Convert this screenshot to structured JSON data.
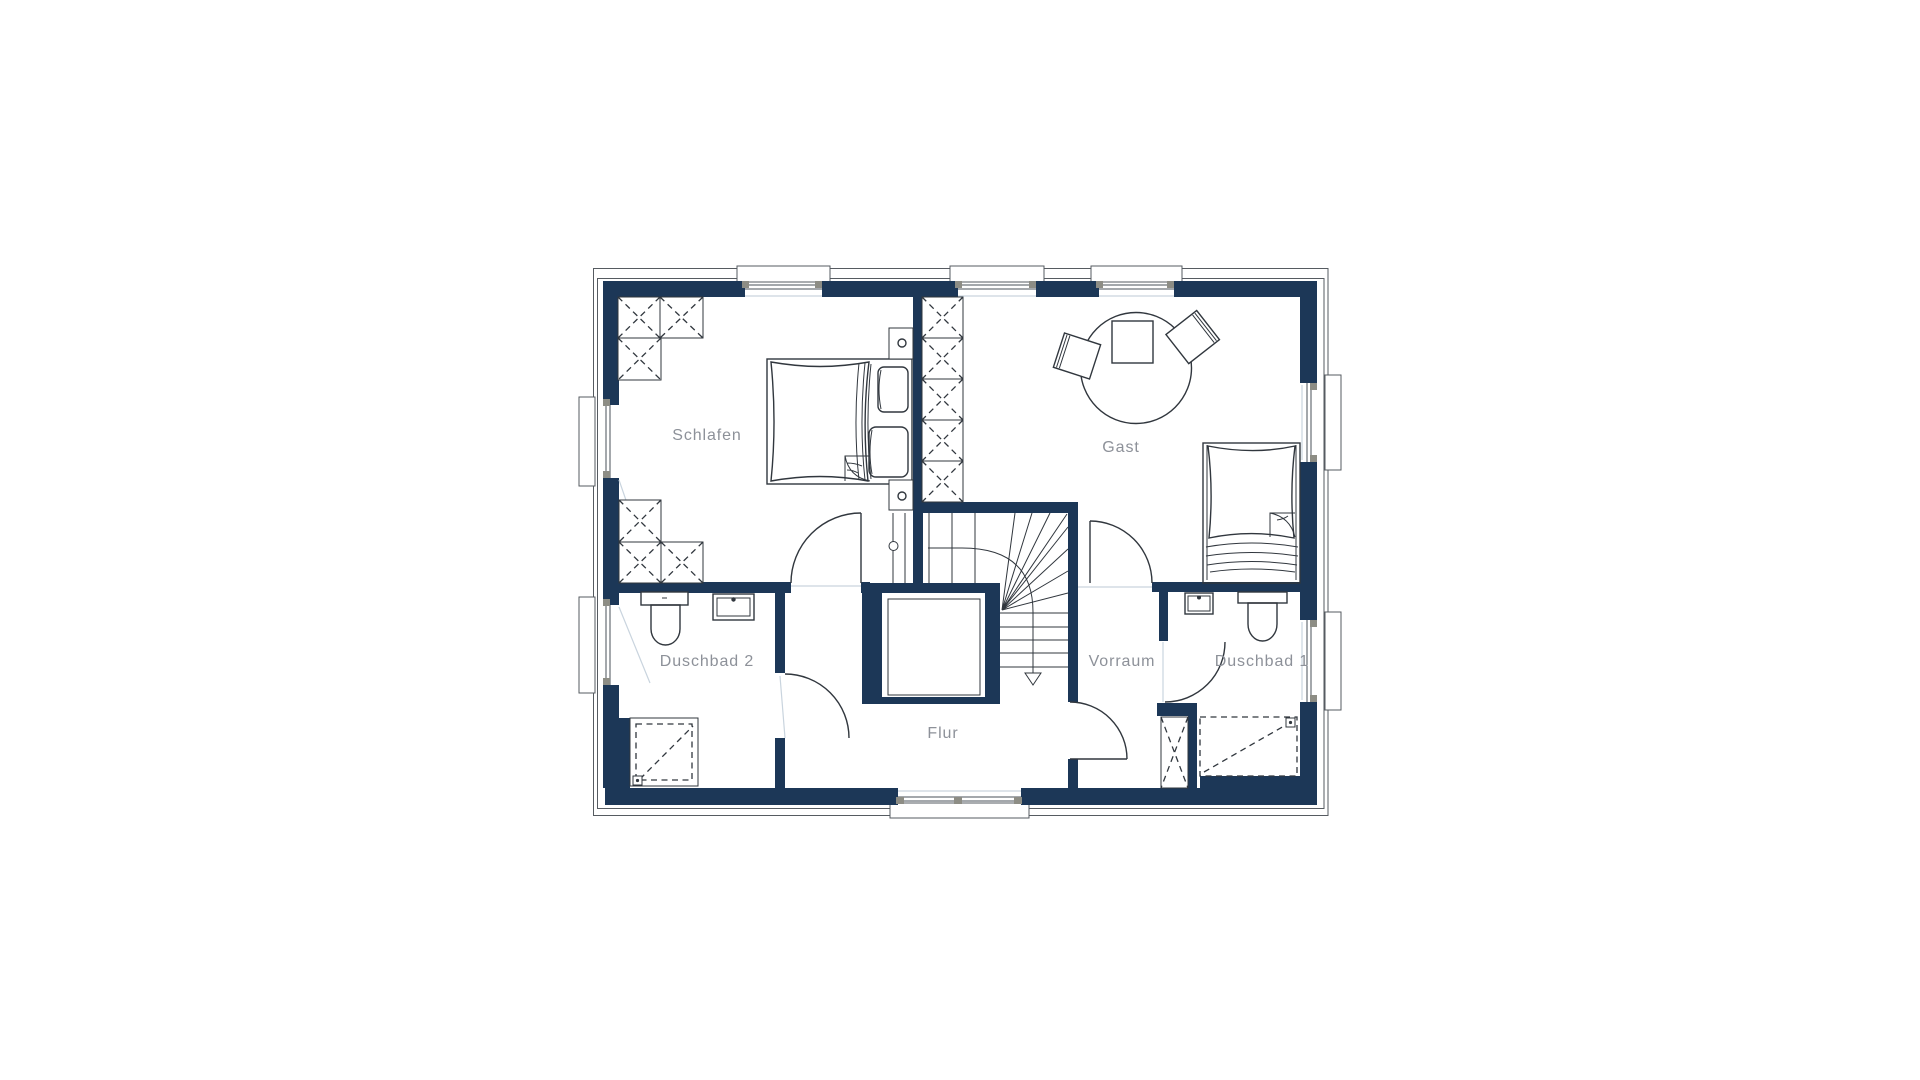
{
  "plan": {
    "title": "",
    "rooms": [
      {
        "id": "schlafen",
        "label": "Schlafen"
      },
      {
        "id": "gast",
        "label": "Gast"
      },
      {
        "id": "duschbad2",
        "label": "Duschbad 2"
      },
      {
        "id": "flur",
        "label": "Flur"
      },
      {
        "id": "vorraum",
        "label": "Vorraum"
      },
      {
        "id": "duschbad1",
        "label": "Duschbad 1"
      }
    ],
    "colors": {
      "wall": "#1c3757",
      "line": "#31373e",
      "label": "#8d9199",
      "faint": "#c9d4de",
      "jamb": "#8d8d85",
      "background": "#ffffff"
    }
  }
}
